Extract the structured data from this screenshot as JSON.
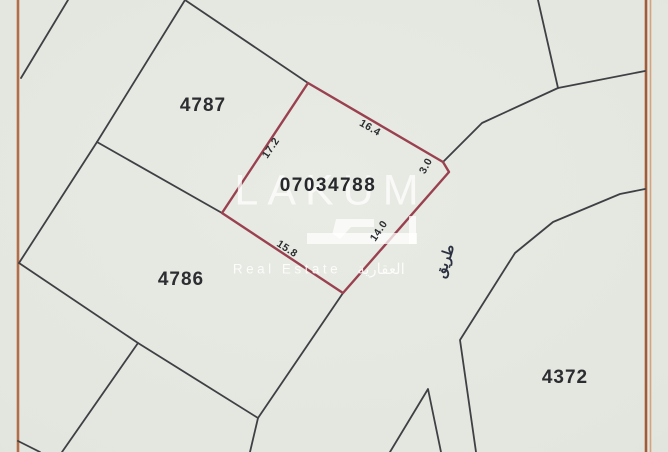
{
  "map": {
    "region_labels": {
      "plot_4787": "4787",
      "plot_4786": "4786",
      "plot_4372": "4372"
    },
    "highlighted_plot": {
      "number": "07034788",
      "outline_color": "#9a4150",
      "edge_dimensions": {
        "left": "17.2",
        "top_right": "16.4",
        "corner": "3.0",
        "bottom_right": "14.0",
        "bottom_left": "15.8"
      }
    },
    "road_label_ar": "طريق",
    "colors": {
      "frame": "#b26e48",
      "boundary_lines": "#3e4044",
      "background": "#e3e5df"
    }
  },
  "watermark": {
    "brand": "LAKUM",
    "tagline_en": "Real Estate",
    "tagline_ar": "العقارية"
  }
}
